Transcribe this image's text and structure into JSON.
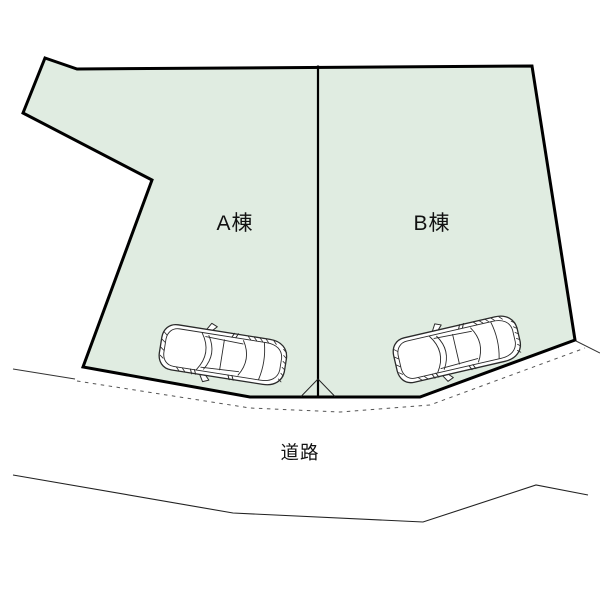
{
  "site_plan": {
    "plots": [
      {
        "id": "A",
        "label": "A棟"
      },
      {
        "id": "B",
        "label": "B棟"
      }
    ],
    "road_label": "道路",
    "vehicles": [
      {
        "name": "car-a",
        "location": "plot-A-frontage"
      },
      {
        "name": "car-b",
        "location": "plot-B-frontage"
      }
    ],
    "colors": {
      "plot_fill": "#e0ece1",
      "outline": "#000000",
      "thin_line": "#333333",
      "dashed_line": "#555555"
    }
  }
}
